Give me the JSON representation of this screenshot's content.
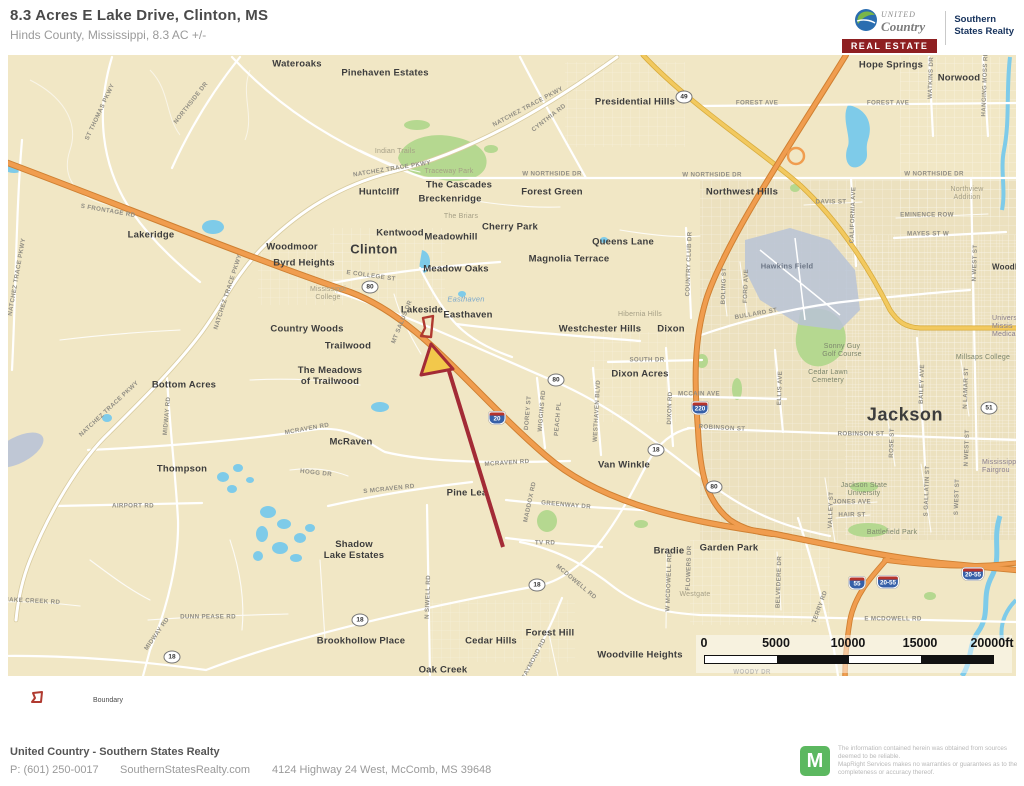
{
  "colors": {
    "map_bg": "#f1e7c5",
    "map_dense": "#e9debc",
    "water": "#7ecbe9",
    "water_gray": "#b9c3d6",
    "park": "#b5d890",
    "hw_orange": "#f09d4f",
    "hw_orange_dark": "#cf8032",
    "hw_yellow": "#f2c95f",
    "hw_yellow_dark": "#d8ac3e",
    "trace_case": "#d8cba0",
    "boundary_red": "#b03a30",
    "arrow_red": "#a32b36",
    "arrow_yellow": "#f2c84b",
    "brand_red": "#8e1f21",
    "brand_navy": "#16325c",
    "maplogo_green": "#5cb860",
    "shield_red": "#b5342c",
    "shield_blue": "#3660a8",
    "label_dark": "#3d3d3d",
    "label_road": "#918e84"
  },
  "header": {
    "title": "8.3 Acres E Lake Drive, Clinton, MS",
    "subtitle": "Hinds County, Mississippi, 8.3 AC +/-",
    "brand": {
      "united": "UNITED",
      "country": "Country",
      "real_estate": "REAL ESTATE",
      "affiliate": "Southern\nStates Realty"
    }
  },
  "map": {
    "place_labels": [
      {
        "t": "Wateroaks",
        "x": 297,
        "y": 65
      },
      {
        "t": "Pinehaven Estates",
        "x": 385,
        "y": 74
      },
      {
        "t": "Presidential Hills",
        "x": 635,
        "y": 103
      },
      {
        "t": "Hope Springs",
        "x": 891,
        "y": 66
      },
      {
        "t": "Norwood",
        "x": 959,
        "y": 79
      },
      {
        "t": "Northwest Hills",
        "x": 742,
        "y": 193
      },
      {
        "t": "Huntcliff",
        "x": 379,
        "y": 193
      },
      {
        "t": "The Cascades",
        "x": 459,
        "y": 186
      },
      {
        "t": "Breckenridge",
        "x": 450,
        "y": 200
      },
      {
        "t": "Forest Green",
        "x": 552,
        "y": 193
      },
      {
        "t": "Cherry Park",
        "x": 510,
        "y": 228
      },
      {
        "t": "Kentwood",
        "x": 400,
        "y": 234
      },
      {
        "t": "Meadowhill",
        "x": 451,
        "y": 238
      },
      {
        "t": "Queens Lane",
        "x": 623,
        "y": 243
      },
      {
        "t": "Magnolia Terrace",
        "x": 569,
        "y": 260
      },
      {
        "t": "Clinton",
        "x": 374,
        "y": 250,
        "cls": "city"
      },
      {
        "t": "Meadow Oaks",
        "x": 456,
        "y": 270
      },
      {
        "t": "Woodmoor",
        "x": 292,
        "y": 248
      },
      {
        "t": "Byrd Heights",
        "x": 304,
        "y": 264
      },
      {
        "t": "Lakeridge",
        "x": 151,
        "y": 236
      },
      {
        "t": "Lakeside",
        "x": 422,
        "y": 311
      },
      {
        "t": "Easthaven",
        "x": 468,
        "y": 316
      },
      {
        "t": "Westchester Hills",
        "x": 600,
        "y": 330
      },
      {
        "t": "Dixon",
        "x": 671,
        "y": 330
      },
      {
        "t": "Dixon Acres",
        "x": 640,
        "y": 375
      },
      {
        "t": "Van Winkle",
        "x": 624,
        "y": 466
      },
      {
        "t": "Jackson",
        "x": 905,
        "y": 415,
        "cls": "city-lg"
      },
      {
        "t": "Country Woods",
        "x": 307,
        "y": 330
      },
      {
        "t": "Trailwood",
        "x": 348,
        "y": 347
      },
      {
        "t": "The Meadows\nof Trailwood",
        "x": 330,
        "y": 377
      },
      {
        "t": "Bottom Acres",
        "x": 184,
        "y": 386
      },
      {
        "t": "McRaven",
        "x": 351,
        "y": 443
      },
      {
        "t": "Thompson",
        "x": 182,
        "y": 470
      },
      {
        "t": "Pine Lea",
        "x": 467,
        "y": 494
      },
      {
        "t": "Shadow\nLake Estates",
        "x": 354,
        "y": 551
      },
      {
        "t": "Brookhollow Place",
        "x": 361,
        "y": 642
      },
      {
        "t": "Cedar Hills",
        "x": 491,
        "y": 642
      },
      {
        "t": "Oak Creek",
        "x": 443,
        "y": 671
      },
      {
        "t": "Forest Hill",
        "x": 550,
        "y": 634
      },
      {
        "t": "Woodville Heights",
        "x": 640,
        "y": 656
      },
      {
        "t": "Garden Park",
        "x": 729,
        "y": 549
      },
      {
        "t": "Bradie",
        "x": 669,
        "y": 552
      },
      {
        "t": "Westgate",
        "x": 695,
        "y": 595,
        "cls": "park"
      },
      {
        "t": "Battlefield Park",
        "x": 892,
        "y": 533,
        "cls": "green"
      },
      {
        "t": "Northview\nAddition",
        "x": 967,
        "y": 194,
        "cls": "park"
      },
      {
        "t": "Hibernia Hills",
        "x": 640,
        "y": 315,
        "cls": "park"
      },
      {
        "t": "Mississippi\nCollege",
        "x": 328,
        "y": 294,
        "cls": "park"
      },
      {
        "t": "Millsaps College",
        "x": 983,
        "y": 358,
        "cls": "green"
      },
      {
        "t": "Hawkins Field",
        "x": 787,
        "y": 267,
        "cls": "apt"
      },
      {
        "t": "Sonny Guy\nGolf Course",
        "x": 842,
        "y": 351,
        "cls": "green"
      },
      {
        "t": "Cedar Lawn\nCemetery",
        "x": 828,
        "y": 377,
        "cls": "green"
      },
      {
        "t": "Jackson State\nUniversity",
        "x": 864,
        "y": 490,
        "cls": "green"
      },
      {
        "t": "Universi\nMissis\nMedical C",
        "x": 992,
        "y": 327,
        "cls": "frag",
        "a": "l"
      },
      {
        "t": "Mississippi\nFairgrou",
        "x": 982,
        "y": 467,
        "cls": "frag",
        "a": "l"
      },
      {
        "t": "Woodla",
        "x": 992,
        "y": 267,
        "cls": "sm",
        "a": "l"
      },
      {
        "t": "Indian Trails",
        "x": 395,
        "y": 152,
        "cls": "park"
      },
      {
        "t": "Traceway Park",
        "x": 449,
        "y": 172,
        "cls": "park"
      },
      {
        "t": "The Briars",
        "x": 461,
        "y": 217,
        "cls": "park"
      },
      {
        "t": "Easthaven",
        "x": 466,
        "y": 300,
        "cls": "wtr"
      }
    ],
    "road_labels": [
      {
        "t": "ST THOMAS PKWY",
        "x": 100,
        "y": 112,
        "r": -65
      },
      {
        "t": "NORTHSIDE DR",
        "x": 191,
        "y": 103,
        "r": -52
      },
      {
        "t": "NATCHEZ TRACE PKWY",
        "x": 528,
        "y": 107,
        "r": -28
      },
      {
        "t": "CYNTHIA RD",
        "x": 549,
        "y": 118,
        "r": -38
      },
      {
        "t": "NATCHEZ TRACE PKWY",
        "x": 392,
        "y": 169,
        "r": -9
      },
      {
        "t": "W NORTHSIDE DR",
        "x": 552,
        "y": 174
      },
      {
        "t": "W NORTHSIDE DR",
        "x": 712,
        "y": 175
      },
      {
        "t": "W NORTHSIDE DR",
        "x": 934,
        "y": 174
      },
      {
        "t": "FOREST AVE",
        "x": 757,
        "y": 103
      },
      {
        "t": "FOREST AVE",
        "x": 888,
        "y": 103
      },
      {
        "t": "NATCHEZ TRACE PKWY",
        "x": 17,
        "y": 277,
        "r": -80
      },
      {
        "t": "S FRONTAGE RD",
        "x": 108,
        "y": 211,
        "r": 10
      },
      {
        "t": "NATCHEZ TRACE PKWY",
        "x": 228,
        "y": 292,
        "r": -72
      },
      {
        "t": "E COLLEGE ST",
        "x": 371,
        "y": 276,
        "r": 8
      },
      {
        "t": "NATCHEZ TRACE PKWY",
        "x": 109,
        "y": 409,
        "r": -43
      },
      {
        "t": "MIDWAY RD",
        "x": 167,
        "y": 416,
        "r": -85
      },
      {
        "t": "AIRPORT RD",
        "x": 133,
        "y": 506
      },
      {
        "t": "MCRAVEN RD",
        "x": 307,
        "y": 429,
        "r": -10
      },
      {
        "t": "MCRAVEN RD",
        "x": 507,
        "y": 463,
        "r": -4
      },
      {
        "t": "S MCRAVEN RD",
        "x": 389,
        "y": 489,
        "r": -6
      },
      {
        "t": "HOGG DR",
        "x": 316,
        "y": 473,
        "r": 6
      },
      {
        "t": "MT SALUS DR",
        "x": 402,
        "y": 322,
        "r": -68
      },
      {
        "t": "WIGGINS RD",
        "x": 542,
        "y": 411,
        "r": -85
      },
      {
        "t": "PEACH PL",
        "x": 558,
        "y": 419,
        "r": -85
      },
      {
        "t": "DOREY ST",
        "x": 528,
        "y": 413,
        "r": -85
      },
      {
        "t": "WESTHAVEN BLVD",
        "x": 597,
        "y": 411,
        "r": -87
      },
      {
        "t": "DIXON RD",
        "x": 670,
        "y": 408,
        "r": -88
      },
      {
        "t": "SOUTH DR",
        "x": 647,
        "y": 360
      },
      {
        "t": "MCCAIN AVE",
        "x": 699,
        "y": 394
      },
      {
        "t": "ROBINSON ST",
        "x": 722,
        "y": 428,
        "r": 3
      },
      {
        "t": "ROBINSON ST",
        "x": 861,
        "y": 434
      },
      {
        "t": "BULLARD ST",
        "x": 756,
        "y": 314,
        "r": -10
      },
      {
        "t": "COUNTRY CLUB DR",
        "x": 689,
        "y": 264,
        "r": -88
      },
      {
        "t": "BOLING ST",
        "x": 724,
        "y": 286,
        "r": -88
      },
      {
        "t": "FORD AVE",
        "x": 746,
        "y": 286,
        "r": -88
      },
      {
        "t": "ELLIS AVE",
        "x": 780,
        "y": 388,
        "r": -88
      },
      {
        "t": "BAILEY AVE",
        "x": 922,
        "y": 384,
        "r": -88
      },
      {
        "t": "ROSE ST",
        "x": 892,
        "y": 443,
        "r": -88
      },
      {
        "t": "N WEST ST",
        "x": 975,
        "y": 263,
        "r": -88
      },
      {
        "t": "N WEST ST",
        "x": 967,
        "y": 448,
        "r": -88
      },
      {
        "t": "N LAMAR ST",
        "x": 966,
        "y": 388,
        "r": -88
      },
      {
        "t": "S GALLATIN ST",
        "x": 927,
        "y": 491,
        "r": -88
      },
      {
        "t": "S WEST ST",
        "x": 957,
        "y": 497,
        "r": -88
      },
      {
        "t": "VALLEY ST",
        "x": 831,
        "y": 510,
        "r": -88
      },
      {
        "t": "JONES AVE",
        "x": 852,
        "y": 502
      },
      {
        "t": "HAIR ST",
        "x": 852,
        "y": 515
      },
      {
        "t": "MAYES ST W",
        "x": 928,
        "y": 234
      },
      {
        "t": "EMINENCE ROW",
        "x": 927,
        "y": 215
      },
      {
        "t": "DAVIS ST",
        "x": 831,
        "y": 202
      },
      {
        "t": "CALIFORNIA AVE",
        "x": 853,
        "y": 215,
        "r": -88
      },
      {
        "t": "WATKINS DR",
        "x": 931,
        "y": 78,
        "r": -88
      },
      {
        "t": "HANGING MOSS RD",
        "x": 985,
        "y": 84,
        "r": -88
      },
      {
        "t": "N SIWELL RD",
        "x": 428,
        "y": 597,
        "r": -88
      },
      {
        "t": "TV RD",
        "x": 545,
        "y": 543
      },
      {
        "t": "MCDOWELL RD",
        "x": 576,
        "y": 582,
        "r": 40
      },
      {
        "t": "GREENWAY DR",
        "x": 566,
        "y": 505,
        "r": 5
      },
      {
        "t": "RAYMOND RD",
        "x": 534,
        "y": 659,
        "r": -62
      },
      {
        "t": "MADDOX RD",
        "x": 530,
        "y": 502,
        "r": -78
      },
      {
        "t": "W MCDOWELL RD",
        "x": 669,
        "y": 582,
        "r": -88
      },
      {
        "t": "FLOWERS DR",
        "x": 689,
        "y": 568,
        "r": -88
      },
      {
        "t": "BELVEDERE DR",
        "x": 779,
        "y": 582,
        "r": -88
      },
      {
        "t": "TERRY RD",
        "x": 820,
        "y": 607,
        "r": -70
      },
      {
        "t": "E MCDOWELL RD",
        "x": 893,
        "y": 619
      },
      {
        "t": "DUNN PEASE RD",
        "x": 208,
        "y": 617
      },
      {
        "t": "SNAKE CREEK RD",
        "x": 30,
        "y": 601,
        "r": 3
      },
      {
        "t": "MIDWAY RD",
        "x": 157,
        "y": 634,
        "r": -55
      },
      {
        "t": "WOODY DR",
        "x": 752,
        "y": 672
      }
    ],
    "shields": [
      {
        "kind": "us",
        "t": "80",
        "x": 370,
        "y": 287
      },
      {
        "kind": "us",
        "t": "80",
        "x": 556,
        "y": 380
      },
      {
        "kind": "us",
        "t": "80",
        "x": 714,
        "y": 487
      },
      {
        "kind": "us",
        "t": "49",
        "x": 684,
        "y": 97
      },
      {
        "kind": "us",
        "t": "51",
        "x": 989,
        "y": 408
      },
      {
        "kind": "us",
        "t": "18",
        "x": 656,
        "y": 450
      },
      {
        "kind": "us",
        "t": "18",
        "x": 537,
        "y": 585
      },
      {
        "kind": "us",
        "t": "18",
        "x": 360,
        "y": 620
      },
      {
        "kind": "us",
        "t": "18",
        "x": 172,
        "y": 657
      },
      {
        "kind": "i",
        "t": "20",
        "x": 497,
        "y": 418
      },
      {
        "kind": "i",
        "t": "220",
        "x": 700,
        "y": 408
      },
      {
        "kind": "i",
        "t": "55",
        "x": 857,
        "y": 583
      },
      {
        "kind": "i",
        "t": "20-55",
        "x": 888,
        "y": 582
      },
      {
        "kind": "i",
        "t": "20-55",
        "x": 973,
        "y": 574
      }
    ],
    "scale": {
      "labels": [
        "0",
        "5000",
        "10000",
        "15000",
        "20000ft"
      ]
    },
    "legend": {
      "boundary_label": "Boundary"
    }
  },
  "footer": {
    "company": "United Country - Southern States Realty",
    "phone": "P: (601) 250-0017",
    "website": "SouthernStatesRealty.com",
    "address": "4124 Highway 24 West, McComb, MS 39648",
    "maplogo_letter": "M",
    "disclaimer": "The information contained herein was obtained from sources\ndeemed to be reliable.\n MapRight Services makes no warranties or guarantees as to the\ncompleteness or accuracy thereof."
  }
}
